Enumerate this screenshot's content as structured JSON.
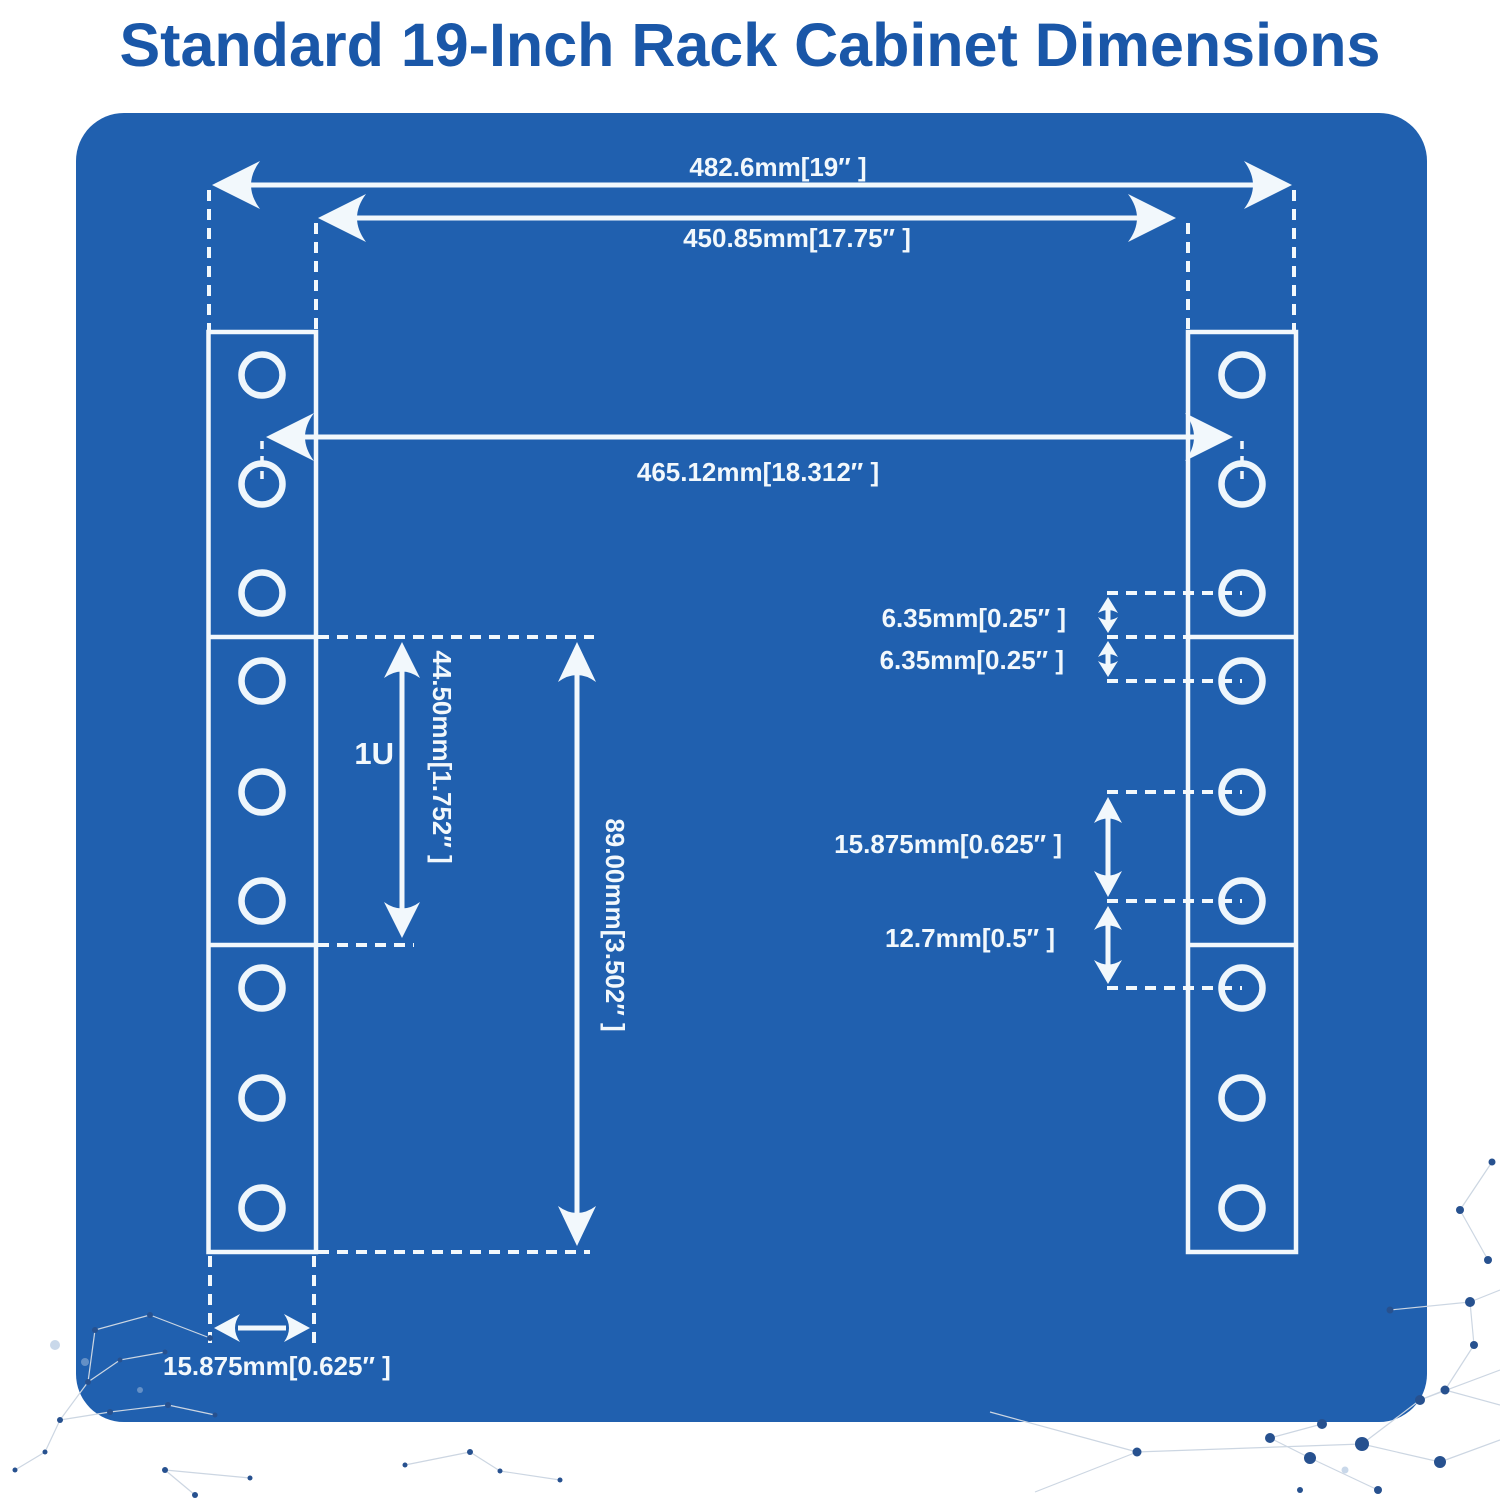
{
  "title": "Standard 19-Inch Rack Cabinet Dimensions",
  "diagram": {
    "labels": {
      "outer_width": "482.6mm[19″ ]",
      "mid_width": "450.85mm[17.75″ ]",
      "hole_center_width": "465.12mm[18.312″ ]",
      "edge_to_hole_upper": "6.35mm[0.25″ ]",
      "edge_to_hole_lower": "6.35mm[0.25″ ]",
      "hole_pitch_wide": "15.875mm[0.625″ ]",
      "hole_pitch_narrow": "12.7mm[0.5″ ]",
      "rack_unit": "1U",
      "rack_unit_height": "44.50mm[1.752″ ]",
      "three_and_half_inch_height": "89.00mm[3.502″ ]",
      "rail_flange_width": "15.875mm[0.625″ ]"
    },
    "colors": {
      "panel_blue": "#2060af",
      "title_blue": "#1a57a8",
      "line_white": "#f2f8fc",
      "network_dot": "#27518f",
      "network_line": "#ccd6e2"
    }
  }
}
